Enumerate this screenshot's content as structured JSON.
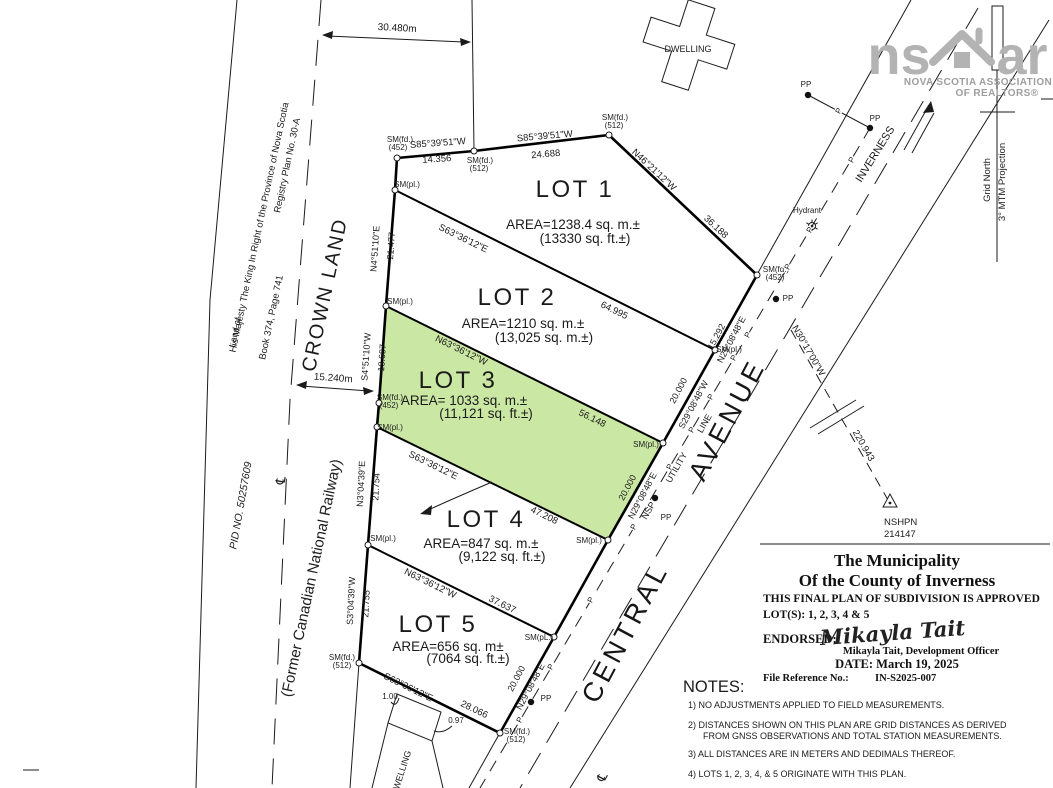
{
  "highlight_color": "#cbe7a4",
  "logo": {
    "left": "ns",
    "right": "ar",
    "house_icon": "house-roof-icon",
    "line1": "NOVA SCOTIA ASSOCIATION",
    "line2": "OF REALTORS®"
  },
  "north": {
    "grid_north": "Grid North",
    "projection": "3° MTM Projection"
  },
  "roads": {
    "central": "CENTRAL",
    "avenue": "AVENUE",
    "inverness": "INVERNESS"
  },
  "monument": {
    "name": "NSHPN",
    "number": "214147"
  },
  "dwellings": {
    "top": "DWELLING",
    "bottom": "DWELLING"
  },
  "left_parcel": {
    "land_of": "Land of",
    "owner": "His Majesty The King In Right of the Province of Nova Scotia",
    "registry": "Registry Plan No. 30-A",
    "book": "Book 374, Page 741"
  },
  "railway": {
    "crown": "CROWN LAND",
    "pid": "PID NO. 50257609",
    "former": "(Former Canadian National Railway)",
    "width_dim": "30.480m",
    "half_width_dim": "15.240m"
  },
  "lots": [
    {
      "name": "LOT 1",
      "area_metric": "AREA=1238.4 sq. m.±",
      "area_imperial": "(13330 sq. ft.±)"
    },
    {
      "name": "LOT 2",
      "area_metric": "AREA=1210 sq. m.±",
      "area_imperial": "(13,025 sq. m.±)"
    },
    {
      "name": "LOT 3",
      "area_metric": "AREA= 1033 sq. m.±",
      "area_imperial": "(11,121 sq. ft.±)"
    },
    {
      "name": "LOT 4",
      "area_metric": "AREA=847 sq. m.±",
      "area_imperial": "(9,122 sq. ft.±)"
    },
    {
      "name": "LOT 5",
      "area_metric": "AREA=656 sq. m±",
      "area_imperial": "(7064 sq. ft.±)"
    }
  ],
  "title_block": {
    "line1": "The Municipality",
    "line2": "Of the County of Inverness",
    "approval": "THIS FINAL PLAN OF SUBDIVISION IS APPROVED",
    "lots_line": "LOT(S): 1, 2, 3, 4 & 5",
    "endorsed_label": "ENDORSED:",
    "signature": "Mikayla Tait",
    "officer": "Mikayla Tait, Development Officer",
    "date_line": "DATE: March 19, 2025",
    "file_ref_label": "File Reference No.:",
    "file_ref": "IN-S2025-007"
  },
  "notes": {
    "heading": "NOTES:",
    "items": [
      "1)  NO  ADJUSTMENTS  APPLIED  TO  FIELD  MEASUREMENTS.",
      "2)  DISTANCES  SHOWN  ON  THIS  PLAN  ARE  GRID  DISTANCES  AS  DERIVED",
      "FROM  GNSS  OBSERVATIONS  AND  TOTAL  STATION  MEASUREMENTS.",
      "3)  ALL  DISTANCES  ARE  IN  METERS  AND  DEDIMALS  THEREOF.",
      "4)  LOTS  1,  2,  3,  4,  &  5  ORIGINATE  WITH  THIS  PLAN."
    ]
  },
  "annotations": [
    {
      "t": "S85°39'51\"W",
      "x": 438,
      "y": 146,
      "r": -4,
      "s": 9.5
    },
    {
      "t": "14.356",
      "x": 437,
      "y": 162,
      "r": -4,
      "s": 9.5
    },
    {
      "t": "S85°39'51\"W",
      "x": 545,
      "y": 139,
      "r": -5,
      "s": 9.5
    },
    {
      "t": "24.688",
      "x": 546,
      "y": 157,
      "r": -5,
      "s": 9.5
    },
    {
      "t": "N46°21'12\"W",
      "x": 652,
      "y": 172,
      "r": 43,
      "s": 9.5
    },
    {
      "t": "36.188",
      "x": 714,
      "y": 229,
      "r": 43,
      "s": 9.5
    },
    {
      "t": "N4°51'10\"E",
      "x": 378,
      "y": 249,
      "r": -86,
      "s": 9
    },
    {
      "t": "21.477",
      "x": 394,
      "y": 246,
      "r": -86,
      "s": 9
    },
    {
      "t": "S4°51'10\"W",
      "x": 369,
      "y": 357,
      "r": -86,
      "s": 9
    },
    {
      "t": "18.697",
      "x": 385,
      "y": 358,
      "r": -86,
      "s": 9
    },
    {
      "t": "N3°04'39\"E",
      "x": 364,
      "y": 484,
      "r": -87,
      "s": 9
    },
    {
      "t": "21.754",
      "x": 379,
      "y": 487,
      "r": -87,
      "s": 9
    },
    {
      "t": "S3°04'39\"W",
      "x": 354,
      "y": 601,
      "r": -87,
      "s": 9
    },
    {
      "t": "21.755",
      "x": 369,
      "y": 604,
      "r": -87,
      "s": 9
    },
    {
      "t": "S63°36'12\"E",
      "x": 462,
      "y": 241,
      "r": 26,
      "s": 9.5
    },
    {
      "t": "64.995",
      "x": 613,
      "y": 313,
      "r": 26,
      "s": 9.5
    },
    {
      "t": "N63°36'12\"W",
      "x": 460,
      "y": 353,
      "r": 26,
      "s": 9.5
    },
    {
      "t": "56.148",
      "x": 591,
      "y": 421,
      "r": 26,
      "s": 9.5
    },
    {
      "t": "S63°36'12\"E",
      "x": 432,
      "y": 468,
      "r": 26,
      "s": 9.5
    },
    {
      "t": "47.208",
      "x": 543,
      "y": 518,
      "r": 26,
      "s": 9.5
    },
    {
      "t": "N63°36'12\"W",
      "x": 429,
      "y": 586,
      "r": 26,
      "s": 9.5
    },
    {
      "t": "37.637",
      "x": 501,
      "y": 607,
      "r": 26,
      "s": 9.5
    },
    {
      "t": "S63°36'12\"E",
      "x": 407,
      "y": 690,
      "r": 26,
      "s": 9.5
    },
    {
      "t": "28.066",
      "x": 473,
      "y": 712,
      "r": 26,
      "s": 9.5
    },
    {
      "t": "15.292",
      "x": 719,
      "y": 338,
      "r": -62,
      "s": 9
    },
    {
      "t": "N29°08'48\"E",
      "x": 734,
      "y": 341,
      "r": -62,
      "s": 9
    },
    {
      "t": "20.000",
      "x": 681,
      "y": 392,
      "r": -62,
      "s": 9
    },
    {
      "t": "S29°08'48\"W",
      "x": 696,
      "y": 406,
      "r": -62,
      "s": 9
    },
    {
      "t": "20.000",
      "x": 630,
      "y": 489,
      "r": -62,
      "s": 9
    },
    {
      "t": "N29°08'48\"E",
      "x": 645,
      "y": 497,
      "r": -62,
      "s": 9
    },
    {
      "t": "20.000",
      "x": 519,
      "y": 680,
      "r": -62,
      "s": 9
    },
    {
      "t": "N29°08'48\"E",
      "x": 533,
      "y": 688,
      "r": -62,
      "s": 9
    },
    {
      "t": "SM(fd.)",
      "x": 400,
      "y": 142,
      "s": 8
    },
    {
      "t": "(452)",
      "x": 398,
      "y": 150,
      "s": 8
    },
    {
      "t": "SM(fd.)",
      "x": 480,
      "y": 163,
      "s": 8
    },
    {
      "t": "(512)",
      "x": 479,
      "y": 171,
      "s": 8
    },
    {
      "t": "SM(fd.)",
      "x": 615,
      "y": 120,
      "s": 8
    },
    {
      "t": "(512)",
      "x": 614,
      "y": 128,
      "s": 8
    },
    {
      "t": "SM(fd.)",
      "x": 776,
      "y": 272,
      "s": 8
    },
    {
      "t": "(452)",
      "x": 775,
      "y": 280,
      "s": 8
    },
    {
      "t": "SM(pl.)",
      "x": 729,
      "y": 352,
      "s": 8
    },
    {
      "t": "SM(pl.)",
      "x": 646,
      "y": 447,
      "s": 8
    },
    {
      "t": "SM(pl.)",
      "x": 589,
      "y": 543,
      "s": 8
    },
    {
      "t": "SM(pL.)",
      "x": 539,
      "y": 640,
      "s": 8
    },
    {
      "t": "SM(fd.)",
      "x": 517,
      "y": 734,
      "s": 8
    },
    {
      "t": "(512)",
      "x": 516,
      "y": 742,
      "s": 8
    },
    {
      "t": "SM(fd.)",
      "x": 342,
      "y": 660,
      "s": 8
    },
    {
      "t": "(512)",
      "x": 342,
      "y": 668,
      "s": 8
    },
    {
      "t": "SM(pl.)",
      "x": 383,
      "y": 541,
      "s": 8
    },
    {
      "t": "SM(pl.)",
      "x": 390,
      "y": 430,
      "s": 8
    },
    {
      "t": "SM(fd.)",
      "x": 390,
      "y": 400,
      "s": 8
    },
    {
      "t": "(452)",
      "x": 389,
      "y": 408,
      "s": 8
    },
    {
      "t": "SM(pl.)",
      "x": 400,
      "y": 304,
      "s": 8
    },
    {
      "t": "SM(pl.)",
      "x": 407,
      "y": 187,
      "s": 8
    },
    {
      "t": "N30°17'00\"W",
      "x": 806,
      "y": 352,
      "r": 60,
      "s": 9.5
    },
    {
      "t": "220.943",
      "x": 861,
      "y": 447,
      "r": 60,
      "s": 9.5
    },
    {
      "b": "monument.name",
      "x": 884,
      "y": 525,
      "s": 9.5,
      "a": "s",
      "n": "monument-label"
    },
    {
      "b": "monument.number",
      "x": 884,
      "y": 537,
      "s": 9.5,
      "a": "s",
      "n": "monument-number"
    },
    {
      "b": "roads.central",
      "x": 633,
      "y": 637,
      "r": -62,
      "s": 27,
      "c": "huge",
      "n": "road-name-central"
    },
    {
      "b": "roads.avenue",
      "x": 735,
      "y": 424,
      "r": -62,
      "s": 27,
      "c": "huge",
      "n": "road-name-avenue"
    },
    {
      "b": "roads.inverness",
      "x": 878,
      "y": 156,
      "r": -58,
      "s": 11,
      "n": "road-name-inverness"
    },
    {
      "t": "Hydrant",
      "x": 807,
      "y": 213,
      "s": 8
    },
    {
      "t": "PP",
      "x": 806,
      "y": 87,
      "s": 8
    },
    {
      "t": "PP",
      "x": 875,
      "y": 121,
      "s": 8
    },
    {
      "t": "PP",
      "x": 788,
      "y": 301,
      "s": 8
    },
    {
      "t": "PP",
      "x": 666,
      "y": 520,
      "s": 8
    },
    {
      "t": "PP",
      "x": 546,
      "y": 701,
      "s": 8
    },
    {
      "t": "P",
      "x": 854,
      "y": 161,
      "r": -62,
      "s": 8,
      "c": "halo"
    },
    {
      "t": "P",
      "x": 812,
      "y": 231,
      "r": -62,
      "s": 8,
      "c": "halo"
    },
    {
      "t": "P",
      "x": 790,
      "y": 268,
      "r": -62,
      "s": 8,
      "c": "halo"
    },
    {
      "t": "P",
      "x": 750,
      "y": 336,
      "r": -62,
      "s": 8,
      "c": "halo"
    },
    {
      "t": "P",
      "x": 736,
      "y": 359,
      "r": -62,
      "s": 8,
      "c": "halo"
    },
    {
      "t": "P",
      "x": 713,
      "y": 398,
      "r": -62,
      "s": 8,
      "c": "halo"
    },
    {
      "t": "P",
      "x": 694,
      "y": 431,
      "r": -62,
      "s": 8,
      "c": "halo"
    },
    {
      "t": "P",
      "x": 672,
      "y": 468,
      "r": -62,
      "s": 8,
      "c": "halo"
    },
    {
      "t": "P",
      "x": 636,
      "y": 528,
      "r": -62,
      "s": 8,
      "c": "halo"
    },
    {
      "t": "P",
      "x": 593,
      "y": 601,
      "r": -62,
      "s": 8,
      "c": "halo"
    },
    {
      "t": "P",
      "x": 553,
      "y": 668,
      "r": -62,
      "s": 8,
      "c": "halo"
    },
    {
      "t": "P",
      "x": 522,
      "y": 721,
      "r": -62,
      "s": 8,
      "c": "halo"
    },
    {
      "t": "P",
      "x": 841,
      "y": 112,
      "r": -62,
      "s": 8,
      "c": "halo"
    },
    {
      "t": "NSP",
      "x": 651,
      "y": 512,
      "r": -60,
      "s": 9
    },
    {
      "t": "UTILITY",
      "x": 679,
      "y": 469,
      "r": -60,
      "s": 9
    },
    {
      "t": "LINE",
      "x": 707,
      "y": 425,
      "r": -60,
      "s": 9
    },
    {
      "b": "north.grid_north",
      "x": 990,
      "y": 180,
      "r": -90,
      "s": 9.5,
      "n": "grid-north-label"
    },
    {
      "b": "north.projection",
      "x": 1005,
      "y": 182,
      "r": -90,
      "s": 9.5,
      "n": "projection-label"
    },
    {
      "b": "dwellings.top",
      "x": 688,
      "y": 52,
      "s": 9,
      "n": "dwelling-top-label"
    },
    {
      "b": "dwellings.bottom",
      "x": 404,
      "y": 774,
      "r": -72,
      "s": 9,
      "n": "dwelling-bottom-label"
    },
    {
      "t": "1.00",
      "x": 390,
      "y": 699,
      "s": 8
    },
    {
      "t": "0.97",
      "x": 456,
      "y": 723,
      "s": 8
    },
    {
      "b": "railway.width_dim",
      "x": 397,
      "y": 31,
      "r": 3,
      "s": 10,
      "n": "railway-width-dim"
    },
    {
      "b": "railway.half_width_dim",
      "x": 333,
      "y": 381,
      "r": 4,
      "s": 10,
      "n": "railway-halfwidth-dim"
    },
    {
      "b": "left_parcel.land_of",
      "x": 238,
      "y": 333,
      "r": -78,
      "s": 9,
      "n": "land-of-label"
    },
    {
      "b": "left_parcel.owner",
      "x": 262,
      "y": 228,
      "r": -78,
      "s": 9.5,
      "n": "owner-label"
    },
    {
      "b": "left_parcel.book",
      "x": 274,
      "y": 318,
      "r": -78,
      "s": 9.5,
      "n": "book-page-label"
    },
    {
      "b": "left_parcel.registry",
      "x": 290,
      "y": 166,
      "r": -78,
      "s": 9.5,
      "n": "registry-plan-label"
    },
    {
      "b": "railway.crown",
      "x": 331,
      "y": 296,
      "r": -78,
      "s": 20,
      "c": "crown",
      "n": "crown-land-label"
    },
    {
      "b": "railway.pid",
      "x": 244,
      "y": 506,
      "r": -80,
      "s": 10.5,
      "c": "it",
      "n": "pid-label"
    },
    {
      "b": "railway.former",
      "x": 316,
      "y": 579,
      "r": -78,
      "s": 15,
      "n": "former-railway-label"
    },
    {
      "t": "℄",
      "x": 285,
      "y": 481,
      "r": -80,
      "s": 13,
      "c": "dv"
    },
    {
      "t": "℄",
      "x": 606,
      "y": 779,
      "r": -62,
      "s": 13,
      "c": "dv"
    },
    {
      "b": "lots.0.name",
      "x": 575,
      "y": 197,
      "s": 24,
      "c": "lot",
      "n": "lot-1-label"
    },
    {
      "b": "lots.0.area_metric",
      "x": 573,
      "y": 229,
      "s": 13.5,
      "n": "lot-1-area-metric"
    },
    {
      "b": "lots.0.area_imperial",
      "x": 585,
      "y": 243,
      "s": 13.5,
      "n": "lot-1-area-imperial"
    },
    {
      "b": "lots.1.name",
      "x": 517,
      "y": 305,
      "s": 24,
      "c": "lot",
      "n": "lot-2-label"
    },
    {
      "b": "lots.1.area_metric",
      "x": 523,
      "y": 328,
      "s": 13.5,
      "n": "lot-2-area-metric"
    },
    {
      "b": "lots.1.area_imperial",
      "x": 544,
      "y": 342,
      "s": 13.5,
      "n": "lot-2-area-imperial"
    },
    {
      "b": "lots.2.name",
      "x": 458,
      "y": 388,
      "s": 24,
      "c": "lot",
      "n": "lot-3-label"
    },
    {
      "b": "lots.2.area_metric",
      "x": 464,
      "y": 405,
      "s": 13.5,
      "n": "lot-3-area-metric"
    },
    {
      "b": "lots.2.area_imperial",
      "x": 486,
      "y": 418,
      "s": 13.5,
      "n": "lot-3-area-imperial"
    },
    {
      "b": "lots.3.name",
      "x": 486,
      "y": 527,
      "s": 24,
      "c": "lot",
      "n": "lot-4-label"
    },
    {
      "b": "lots.3.area_metric",
      "x": 481,
      "y": 548,
      "s": 13.5,
      "n": "lot-4-area-metric"
    },
    {
      "b": "lots.3.area_imperial",
      "x": 502,
      "y": 561,
      "s": 13.5,
      "n": "lot-4-area-imperial"
    },
    {
      "b": "lots.4.name",
      "x": 438,
      "y": 632,
      "s": 24,
      "c": "lot",
      "n": "lot-5-label"
    },
    {
      "b": "lots.4.area_metric",
      "x": 448,
      "y": 651,
      "s": 13.5,
      "n": "lot-5-area-metric"
    },
    {
      "b": "lots.4.area_imperial",
      "x": 468,
      "y": 663,
      "s": 13.5,
      "n": "lot-5-area-imperial"
    },
    {
      "b": "title_block.line1",
      "x": 897,
      "y": 566,
      "s": 17,
      "c": "tb",
      "n": "title-municipality"
    },
    {
      "b": "title_block.line2",
      "x": 897,
      "y": 586,
      "s": 17,
      "c": "tb",
      "n": "title-county"
    },
    {
      "b": "title_block.approval",
      "x": 763,
      "y": 602,
      "s": 11.5,
      "c": "tb",
      "a": "s",
      "n": "approval-line"
    },
    {
      "b": "title_block.lots_line",
      "x": 763,
      "y": 618,
      "s": 11.5,
      "c": "tb",
      "a": "s",
      "n": "approved-lots-line"
    },
    {
      "b": "title_block.endorsed_label",
      "x": 763,
      "y": 643,
      "s": 12.5,
      "c": "tb",
      "a": "s",
      "n": "endorsed-label"
    },
    {
      "b": "title_block.signature",
      "x": 893,
      "y": 640,
      "r": -4,
      "s": 21,
      "c": "sig",
      "n": "signature"
    },
    {
      "b": "title_block.officer",
      "x": 921,
      "y": 654,
      "s": 10.5,
      "c": "tb",
      "n": "officer-name"
    },
    {
      "b": "title_block.date_line",
      "x": 897,
      "y": 668,
      "s": 12.5,
      "c": "tb",
      "n": "approval-date"
    },
    {
      "b": "title_block.file_ref_label",
      "x": 763,
      "y": 681,
      "s": 10.5,
      "c": "tb",
      "a": "s",
      "n": "file-ref-label"
    },
    {
      "b": "title_block.file_ref",
      "x": 875,
      "y": 681,
      "s": 10.5,
      "c": "tb",
      "a": "s",
      "n": "file-ref-value"
    },
    {
      "b": "notes.heading",
      "x": 683,
      "y": 692,
      "s": 16.5,
      "a": "s",
      "n": "notes-heading"
    },
    {
      "b": "notes.items.0",
      "x": 688,
      "y": 708,
      "s": 9,
      "a": "s",
      "n": "note-1"
    },
    {
      "b": "notes.items.1",
      "x": 688,
      "y": 728,
      "s": 9,
      "a": "s",
      "n": "note-2"
    },
    {
      "b": "notes.items.2",
      "x": 703,
      "y": 739,
      "s": 9,
      "a": "s",
      "n": "note-2-cont"
    },
    {
      "b": "notes.items.3",
      "x": 688,
      "y": 757,
      "s": 9,
      "a": "s",
      "n": "note-3"
    },
    {
      "b": "notes.items.4",
      "x": 688,
      "y": 777,
      "s": 9,
      "a": "s",
      "n": "note-4"
    },
    {
      "b": "logo.left",
      "x": 899,
      "y": 74,
      "s": 54,
      "c": "logotxt",
      "n": "logo-ns"
    },
    {
      "b": "logo.right",
      "x": 1022,
      "y": 74,
      "s": 54,
      "c": "logotxt",
      "n": "logo-ar"
    },
    {
      "b": "logo.line1",
      "x": 978,
      "y": 85,
      "s": 10,
      "c": "logosub",
      "n": "logo-subtitle-1"
    },
    {
      "b": "logo.line2",
      "x": 997,
      "y": 96,
      "s": 10,
      "c": "logosub",
      "n": "logo-subtitle-2"
    }
  ]
}
